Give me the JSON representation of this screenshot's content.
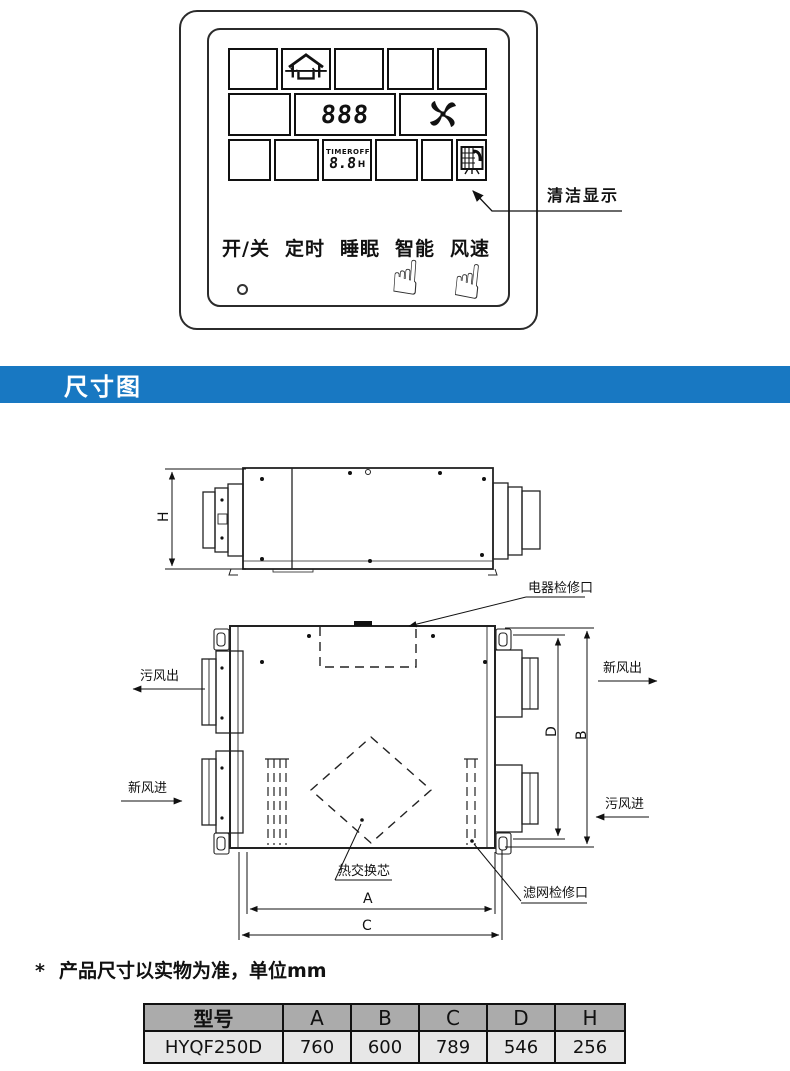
{
  "panel": {
    "display": {
      "value": "888",
      "timer_label": "TIMER",
      "timer_state": "OFF",
      "timer_value": "8.8",
      "timer_unit": "H"
    },
    "buttons": [
      "开/关",
      "定时",
      "睡眠",
      "智能",
      "风速"
    ],
    "annotation": "清洁显示",
    "hand_icon": "☝"
  },
  "banner": {
    "title": "尺寸图",
    "bg_color": "#1878c2"
  },
  "diagram": {
    "labels": {
      "h": "H",
      "a": "A",
      "b": "B",
      "c": "C",
      "d": "D",
      "electrical_access": "电器检修口",
      "stale_out": "污风出",
      "fresh_in": "新风进",
      "fresh_out": "新风出",
      "stale_in": "污风进",
      "core": "热交换芯",
      "filter_access": "滤网检修口"
    }
  },
  "note": {
    "marker": "*",
    "text": "产品尺寸以实物为准，单位mm"
  },
  "spec_table": {
    "headers": [
      "型号",
      "A",
      "B",
      "C",
      "D",
      "H"
    ],
    "row": [
      "HYQF250D",
      "760",
      "600",
      "789",
      "546",
      "256"
    ],
    "header_bg": "#ababab",
    "row_bg": "#e7e7e7"
  }
}
